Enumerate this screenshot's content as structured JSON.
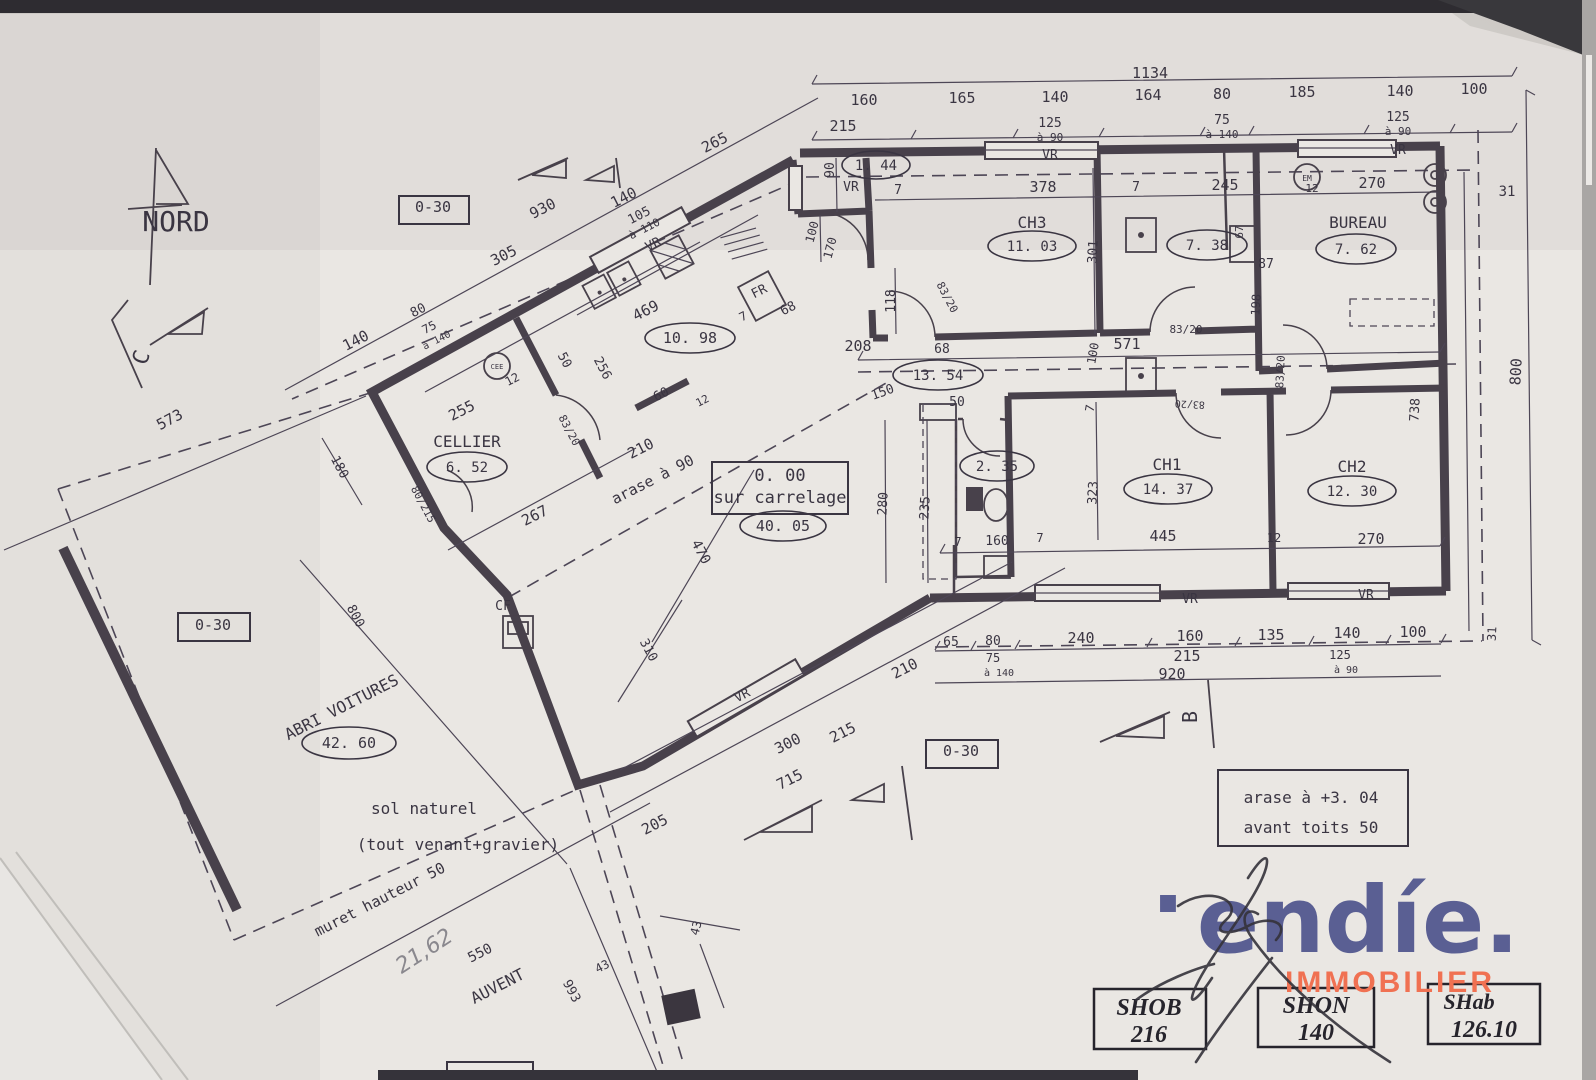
{
  "plan": {
    "north_label": "NORD",
    "labels": [
      {
        "n": "dim-1134",
        "t": "1134",
        "x": 1150,
        "y": 78
      },
      {
        "n": "dim-top-160",
        "t": "160",
        "x": 864,
        "y": 105
      },
      {
        "n": "dim-top-165",
        "t": "165",
        "x": 962,
        "y": 103
      },
      {
        "n": "dim-top-140a",
        "t": "140",
        "x": 1055,
        "y": 102
      },
      {
        "n": "dim-top-164",
        "t": "164",
        "x": 1148,
        "y": 100
      },
      {
        "n": "dim-top-80",
        "t": "80",
        "x": 1222,
        "y": 99
      },
      {
        "n": "dim-top-185",
        "t": "185",
        "x": 1302,
        "y": 97
      },
      {
        "n": "dim-top-140b",
        "t": "140",
        "x": 1400,
        "y": 96
      },
      {
        "n": "dim-top-100",
        "t": "100",
        "x": 1474,
        "y": 94
      },
      {
        "n": "dim-top-215",
        "t": "215",
        "x": 843,
        "y": 131
      },
      {
        "n": "win-top1-125",
        "t": "125",
        "x": 1050,
        "y": 127,
        "s": 13
      },
      {
        "n": "win-top1-a90",
        "t": "à 90",
        "x": 1050,
        "y": 141,
        "s": 11
      },
      {
        "n": "win-top2-75",
        "t": "75",
        "x": 1222,
        "y": 124,
        "s": 13
      },
      {
        "n": "win-top2-a140",
        "t": "à 140",
        "x": 1222,
        "y": 138,
        "s": 11
      },
      {
        "n": "win-top3-125",
        "t": "125",
        "x": 1398,
        "y": 121,
        "s": 13
      },
      {
        "n": "win-top3-a90",
        "t": "à 90",
        "x": 1398,
        "y": 135,
        "s": 11
      },
      {
        "n": "win-top1-vr",
        "t": "VR",
        "x": 1050,
        "y": 159,
        "s": 13
      },
      {
        "n": "win-top3-vr",
        "t": "VR",
        "x": 1398,
        "y": 154,
        "s": 13
      },
      {
        "n": "dim-31-top",
        "t": "31",
        "x": 1507,
        "y": 196,
        "s": 14
      },
      {
        "n": "dim-7a",
        "t": "7",
        "x": 898,
        "y": 194,
        "s": 13
      },
      {
        "n": "dim-378",
        "t": "378",
        "x": 1043,
        "y": 192
      },
      {
        "n": "dim-7b",
        "t": "7",
        "x": 1136,
        "y": 191,
        "s": 13
      },
      {
        "n": "dim-245",
        "t": "245",
        "x": 1225,
        "y": 190
      },
      {
        "n": "dim-12-bath",
        "t": "12",
        "x": 1312,
        "y": 192,
        "s": 11
      },
      {
        "n": "dim-270-bureau",
        "t": "270",
        "x": 1372,
        "y": 188
      },
      {
        "n": "room-entry-area",
        "t": "1. 44",
        "x": 876,
        "y": 170,
        "s": 14
      },
      {
        "n": "entry-vr",
        "t": "VR",
        "x": 851,
        "y": 191,
        "s": 13
      },
      {
        "n": "dim-90",
        "t": "90",
        "x": 834,
        "y": 170,
        "r": -90,
        "s": 13
      },
      {
        "n": "dim-100-entry",
        "t": "100",
        "x": 816,
        "y": 233,
        "r": -75,
        "s": 12
      },
      {
        "n": "dim-170",
        "t": "170",
        "x": 834,
        "y": 249,
        "r": -75,
        "s": 12
      },
      {
        "n": "dim-265",
        "t": "265",
        "x": 717,
        "y": 147,
        "r": -27
      },
      {
        "n": "dim-930",
        "t": "930",
        "x": 545,
        "y": 213,
        "r": -27
      },
      {
        "n": "dim-140-wing",
        "t": "140",
        "x": 626,
        "y": 202,
        "r": -27
      },
      {
        "n": "win-kitchen-105",
        "t": "105",
        "x": 641,
        "y": 219,
        "r": -27,
        "s": 13
      },
      {
        "n": "win-kitchen-a110",
        "t": "à 110",
        "x": 646,
        "y": 232,
        "r": -27,
        "s": 11
      },
      {
        "n": "kitchen-vr",
        "t": "VR",
        "x": 655,
        "y": 248,
        "r": -27,
        "s": 13
      },
      {
        "n": "dim-305",
        "t": "305",
        "x": 506,
        "y": 260,
        "r": -27
      },
      {
        "n": "dim-140-left",
        "t": "140",
        "x": 358,
        "y": 345,
        "r": -27
      },
      {
        "n": "dim-80-left",
        "t": "80",
        "x": 420,
        "y": 314,
        "r": -27,
        "s": 13
      },
      {
        "n": "win-cellier-75",
        "t": "75",
        "x": 431,
        "y": 331,
        "r": -27,
        "s": 12
      },
      {
        "n": "win-cellier-a140",
        "t": "à 140",
        "x": 438,
        "y": 343,
        "r": -27,
        "s": 10
      },
      {
        "n": "dim-573",
        "t": "573",
        "x": 172,
        "y": 424,
        "r": -28
      },
      {
        "n": "dim-180",
        "t": "180",
        "x": 336,
        "y": 469,
        "r": 62,
        "s": 13
      },
      {
        "n": "dim-469",
        "t": "469",
        "x": 648,
        "y": 315,
        "r": -27
      },
      {
        "n": "dim-256",
        "t": "256",
        "x": 599,
        "y": 370,
        "r": 62,
        "s": 13
      },
      {
        "n": "dim-50-kitchen",
        "t": "50",
        "x": 561,
        "y": 362,
        "r": 62,
        "s": 13
      },
      {
        "n": "dim-12-kitchen",
        "t": "12",
        "x": 514,
        "y": 383,
        "r": -27,
        "s": 12
      },
      {
        "n": "dim-255",
        "t": "255",
        "x": 464,
        "y": 415,
        "r": -27
      },
      {
        "n": "sym-cee-label",
        "t": "CEE",
        "x": 497,
        "y": 369,
        "s": 7
      },
      {
        "n": "dim-60",
        "t": "60",
        "x": 663,
        "y": 398,
        "r": -27,
        "s": 13
      },
      {
        "n": "dim-12b",
        "t": "12",
        "x": 704,
        "y": 404,
        "r": -27,
        "s": 11
      },
      {
        "n": "dim-210-arase",
        "t": "210",
        "x": 643,
        "y": 453,
        "r": -27
      },
      {
        "n": "note-arase90",
        "t": "arase à 90",
        "x": 655,
        "y": 484,
        "r": -27
      },
      {
        "n": "dim-267",
        "t": "267",
        "x": 537,
        "y": 520,
        "r": -27
      },
      {
        "n": "door-8320-cellier",
        "t": "83/20",
        "x": 566,
        "y": 432,
        "r": 62,
        "s": 11
      },
      {
        "n": "door-80215-cellier",
        "t": "80/215",
        "x": 420,
        "y": 506,
        "r": 62,
        "s": 11
      },
      {
        "n": "room-cellier",
        "t": "CELLIER",
        "x": 467,
        "y": 447,
        "s": 16
      },
      {
        "n": "room-cellier-area",
        "t": "6. 52",
        "x": 467,
        "y": 472,
        "s": 14
      },
      {
        "n": "room-kitchen-area",
        "t": "10. 98",
        "x": 690,
        "y": 343,
        "s": 15
      },
      {
        "n": "fridge-label",
        "t": "FR",
        "x": 761,
        "y": 295,
        "r": -27,
        "s": 13
      },
      {
        "n": "dim-7-fr",
        "t": "7",
        "x": 745,
        "y": 320,
        "r": -27,
        "s": 12
      },
      {
        "n": "dim-68-fr",
        "t": "68",
        "x": 790,
        "y": 312,
        "r": -27,
        "s": 13
      },
      {
        "n": "dim-208",
        "t": "208",
        "x": 858,
        "y": 351
      },
      {
        "n": "dim-68-hall",
        "t": "68",
        "x": 942,
        "y": 353,
        "s": 13
      },
      {
        "n": "dim-571",
        "t": "571",
        "x": 1127,
        "y": 349
      },
      {
        "n": "dim-100-hall",
        "t": "100",
        "x": 1097,
        "y": 354,
        "r": -80,
        "s": 12
      },
      {
        "n": "dim-118",
        "t": "118",
        "x": 895,
        "y": 301,
        "r": -90,
        "s": 13
      },
      {
        "n": "door-8320-ch3",
        "t": "83/20",
        "x": 944,
        "y": 299,
        "r": 62,
        "s": 11
      },
      {
        "n": "room-hall-area",
        "t": "13. 54",
        "x": 938,
        "y": 380,
        "s": 14
      },
      {
        "n": "dim-150",
        "t": "150",
        "x": 884,
        "y": 396,
        "r": -20,
        "s": 13
      },
      {
        "n": "dim-50-hall",
        "t": "50",
        "x": 957,
        "y": 406,
        "s": 13
      },
      {
        "n": "dim-7-hall",
        "t": "7",
        "x": 1094,
        "y": 409,
        "r": -80,
        "s": 12
      },
      {
        "n": "room-ch3",
        "t": "CH3",
        "x": 1032,
        "y": 228,
        "s": 16
      },
      {
        "n": "room-ch3-area",
        "t": "11. 03",
        "x": 1032,
        "y": 251,
        "s": 14
      },
      {
        "n": "dim-301",
        "t": "301",
        "x": 1097,
        "y": 252,
        "r": -87,
        "s": 13
      },
      {
        "n": "room-bath-area",
        "t": "7. 38",
        "x": 1207,
        "y": 250,
        "s": 14
      },
      {
        "n": "dim-67",
        "t": "67",
        "x": 1243,
        "y": 232,
        "r": -90,
        "s": 11
      },
      {
        "n": "dim-87",
        "t": "87",
        "x": 1266,
        "y": 268,
        "s": 13
      },
      {
        "n": "dim-198",
        "t": "198",
        "x": 1260,
        "y": 305,
        "r": -87,
        "s": 12
      },
      {
        "n": "door-8320-bath",
        "t": "83/20",
        "x": 1186,
        "y": 333,
        "s": 11
      },
      {
        "n": "door-8320-bureau",
        "t": "83/20",
        "x": 1284,
        "y": 372,
        "r": -87,
        "s": 11
      },
      {
        "n": "room-bureau",
        "t": "BUREAU",
        "x": 1358,
        "y": 228,
        "s": 16
      },
      {
        "n": "room-bureau-area",
        "t": "7. 62",
        "x": 1356,
        "y": 254,
        "s": 14
      },
      {
        "n": "sym-em-label",
        "t": "EM",
        "x": 1307,
        "y": 181,
        "s": 8
      },
      {
        "n": "room-wc-area",
        "t": "2. 35",
        "x": 997,
        "y": 471,
        "s": 14
      },
      {
        "n": "dim-235",
        "t": "235",
        "x": 929,
        "y": 508,
        "r": -87,
        "s": 13
      },
      {
        "n": "dim-280",
        "t": "280",
        "x": 887,
        "y": 504,
        "r": -87,
        "s": 13
      },
      {
        "n": "dim-160-wc",
        "t": "160",
        "x": 997,
        "y": 545,
        "s": 13
      },
      {
        "n": "dim-7-wc1",
        "t": "7",
        "x": 958,
        "y": 546,
        "s": 12
      },
      {
        "n": "dim-7-wc2",
        "t": "7",
        "x": 1040,
        "y": 542,
        "s": 12
      },
      {
        "n": "room-ch1",
        "t": "CH1",
        "x": 1167,
        "y": 470,
        "s": 16
      },
      {
        "n": "room-ch1-area",
        "t": "14. 37",
        "x": 1168,
        "y": 494,
        "s": 14
      },
      {
        "n": "dim-323",
        "t": "323",
        "x": 1097,
        "y": 493,
        "r": -87,
        "s": 13
      },
      {
        "n": "dim-445",
        "t": "445",
        "x": 1163,
        "y": 541
      },
      {
        "n": "dim-12-ch2",
        "t": "12",
        "x": 1274,
        "y": 542,
        "s": 12
      },
      {
        "n": "door-8320-ch1",
        "t": "83/20",
        "x": 1190,
        "y": 401,
        "r": -177,
        "s": 10
      },
      {
        "n": "room-ch2",
        "t": "CH2",
        "x": 1352,
        "y": 472,
        "s": 16
      },
      {
        "n": "room-ch2-area",
        "t": "12. 30",
        "x": 1352,
        "y": 496,
        "s": 14
      },
      {
        "n": "dim-270-ch2",
        "t": "270",
        "x": 1371,
        "y": 544
      },
      {
        "n": "dim-738",
        "t": "738",
        "x": 1419,
        "y": 410,
        "r": -87,
        "s": 13
      },
      {
        "n": "dim-800-right",
        "t": "800",
        "x": 1521,
        "y": 372,
        "r": -87
      },
      {
        "n": "dim-31-bottom",
        "t": "31",
        "x": 1496,
        "y": 634,
        "r": -87,
        "s": 12
      },
      {
        "n": "bottom-vr1",
        "t": "VR",
        "x": 1190,
        "y": 603,
        "s": 13
      },
      {
        "n": "bottom-vr2",
        "t": "VR",
        "x": 1366,
        "y": 599,
        "s": 13
      },
      {
        "n": "dim-65",
        "t": "65",
        "x": 951,
        "y": 646,
        "s": 13
      },
      {
        "n": "dim-80-bottom",
        "t": "80",
        "x": 993,
        "y": 645,
        "s": 13
      },
      {
        "n": "dim-240",
        "t": "240",
        "x": 1081,
        "y": 643
      },
      {
        "n": "dim-160-bottom",
        "t": "160",
        "x": 1190,
        "y": 641
      },
      {
        "n": "dim-135",
        "t": "135",
        "x": 1271,
        "y": 640
      },
      {
        "n": "dim-140-bottom",
        "t": "140",
        "x": 1347,
        "y": 638
      },
      {
        "n": "dim-100-bottom",
        "t": "100",
        "x": 1413,
        "y": 637
      },
      {
        "n": "win-b1-75",
        "t": "75",
        "x": 993,
        "y": 662,
        "s": 12
      },
      {
        "n": "win-b1-a140",
        "t": "à 140",
        "x": 999,
        "y": 676,
        "s": 10
      },
      {
        "n": "dim-215-bottom",
        "t": "215",
        "x": 1187,
        "y": 661
      },
      {
        "n": "win-b2-125",
        "t": "125",
        "x": 1340,
        "y": 659,
        "s": 12
      },
      {
        "n": "win-b2-a90",
        "t": "à 90",
        "x": 1346,
        "y": 673,
        "s": 10
      },
      {
        "n": "dim-920",
        "t": "920",
        "x": 1172,
        "y": 679
      },
      {
        "n": "dim-210-b",
        "t": "210",
        "x": 907,
        "y": 673,
        "r": -27
      },
      {
        "n": "note-000",
        "t": "0. 00",
        "x": 780,
        "y": 481,
        "s": 17
      },
      {
        "n": "note-carrelage",
        "t": "sur carrelage",
        "x": 780,
        "y": 503,
        "s": 17
      },
      {
        "n": "room-living-area",
        "t": "40. 05",
        "x": 783,
        "y": 531,
        "s": 15
      },
      {
        "n": "dim-470",
        "t": "470",
        "x": 697,
        "y": 554,
        "r": 62,
        "s": 14
      },
      {
        "n": "dim-310",
        "t": "310",
        "x": 645,
        "y": 652,
        "r": 62,
        "s": 13
      },
      {
        "n": "living-vr",
        "t": "VR",
        "x": 744,
        "y": 699,
        "r": -27,
        "s": 13
      },
      {
        "n": "dim-300",
        "t": "300",
        "x": 790,
        "y": 748,
        "r": -27
      },
      {
        "n": "dim-215-terr",
        "t": "215",
        "x": 845,
        "y": 737,
        "r": -27
      },
      {
        "n": "dim-715",
        "t": "715",
        "x": 792,
        "y": 784,
        "r": -27
      },
      {
        "n": "dim-205",
        "t": "205",
        "x": 657,
        "y": 829,
        "r": -27
      },
      {
        "n": "cf-label",
        "t": "CF",
        "x": 503,
        "y": 610,
        "s": 13
      },
      {
        "n": "room-carport-1",
        "t": "ABRI VOITURES",
        "x": 344,
        "y": 712,
        "r": -27,
        "s": 16
      },
      {
        "n": "room-carport-area",
        "t": "42. 60",
        "x": 349,
        "y": 748,
        "s": 15
      },
      {
        "n": "dim-800-carport",
        "t": "800",
        "x": 352,
        "y": 618,
        "r": 62,
        "s": 13
      },
      {
        "n": "note-sol",
        "t": "sol naturel",
        "x": 424,
        "y": 814,
        "s": 16
      },
      {
        "n": "note-toutvenant",
        "t": "(tout venant+gravier)",
        "x": 458,
        "y": 850,
        "s": 16
      },
      {
        "n": "note-muret",
        "t": "muret hauteur 50",
        "x": 382,
        "y": 904,
        "r": -27,
        "s": 15
      },
      {
        "n": "dim-550",
        "t": "550",
        "x": 482,
        "y": 957,
        "r": -27,
        "s": 14
      },
      {
        "n": "note-auvent",
        "t": "AUVENT",
        "x": 500,
        "y": 991,
        "r": -27,
        "s": 16
      },
      {
        "n": "dim-993",
        "t": "993",
        "x": 568,
        "y": 993,
        "r": 62,
        "s": 13
      },
      {
        "n": "dim-43a",
        "t": "43",
        "x": 604,
        "y": 970,
        "r": -27,
        "s": 12
      },
      {
        "n": "dim-43b",
        "t": "43",
        "x": 700,
        "y": 929,
        "r": -75,
        "s": 12
      },
      {
        "n": "hand-2162",
        "t": "21,62",
        "x": 428,
        "y": 957,
        "r": -33,
        "s": 22,
        "cl": "pencil"
      },
      {
        "n": "ref-box-top",
        "t": "0-30",
        "x": 433,
        "y": 212
      },
      {
        "n": "ref-box-left",
        "t": "0-30",
        "x": 213,
        "y": 630
      },
      {
        "n": "ref-box-bottom",
        "t": "0-30",
        "x": 961,
        "y": 756
      },
      {
        "n": "note-arase304-1",
        "t": "arase à +3. 04",
        "x": 1311,
        "y": 803,
        "s": 16
      },
      {
        "n": "note-arase304-2",
        "t": "avant toits 50",
        "x": 1311,
        "y": 833,
        "s": 16
      },
      {
        "n": "shob-label",
        "t": "SHOB",
        "x": 1149,
        "y": 1015,
        "cl": "serif",
        "s": 24
      },
      {
        "n": "shob-value",
        "t": "216",
        "x": 1149,
        "y": 1042,
        "cl": "serif",
        "s": 24
      },
      {
        "n": "shon-label",
        "t": "SHON",
        "x": 1316,
        "y": 1013,
        "cl": "serif",
        "s": 24
      },
      {
        "n": "shon-value",
        "t": "140",
        "x": 1316,
        "y": 1040,
        "cl": "serif",
        "s": 24
      },
      {
        "n": "shab-label",
        "t": "SHab",
        "x": 1469,
        "y": 1009,
        "cl": "serif",
        "s": 22
      },
      {
        "n": "shab-value",
        "t": "126.10",
        "x": 1484,
        "y": 1037,
        "cl": "serif",
        "s": 24
      },
      {
        "n": "north-label",
        "t": "NORD",
        "x": 176,
        "y": 231,
        "s": 28
      },
      {
        "n": "section-c-label",
        "t": "C",
        "x": 148,
        "y": 360,
        "r": -70,
        "s": 22
      },
      {
        "n": "section-b-label",
        "t": "B",
        "x": 1197,
        "y": 717,
        "r": -90,
        "s": 20
      },
      {
        "n": "logo-dot",
        "t": "·",
        "x": 1168,
        "y": 935,
        "cl": "logo",
        "s": 90
      },
      {
        "n": "logo-wordmark",
        "t": "endíe.",
        "x": 1358,
        "y": 952,
        "cl": "logo",
        "s": 92
      },
      {
        "n": "logo-tagline",
        "t": "IMMOBILIER",
        "x": 1390,
        "y": 992,
        "cl": "tag",
        "s": 30
      }
    ]
  }
}
